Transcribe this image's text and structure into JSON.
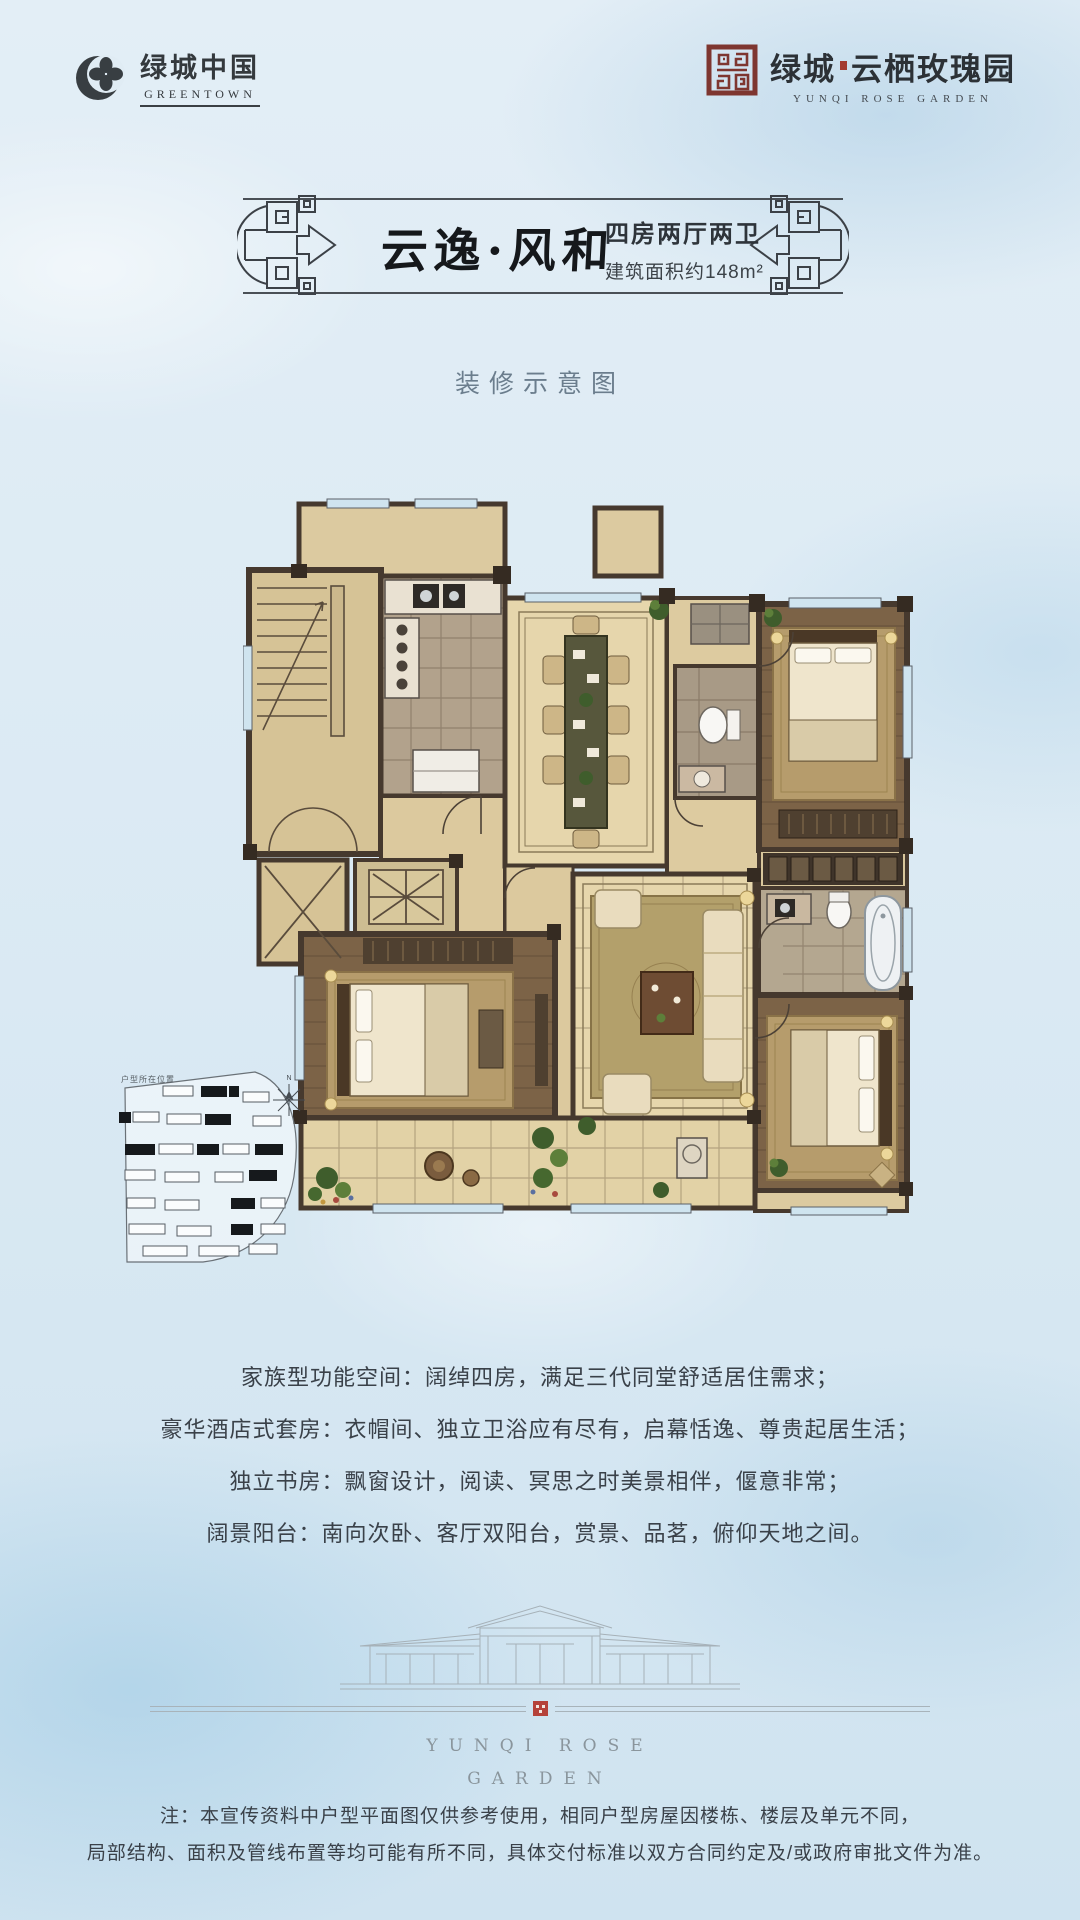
{
  "header": {
    "greentown": {
      "cn": "绿城中国",
      "en": "GREENTOWN"
    },
    "project": {
      "cn_prefix": "绿城",
      "cn_name": "云栖玫瑰园",
      "en": "YUNQI ROSE GARDEN"
    }
  },
  "banner": {
    "title": "云逸·风和",
    "layout": "四房两厅两卫",
    "area": "建筑面积约148m²"
  },
  "caption": "装修示意图",
  "siteplan": {
    "label": "户型所在位置",
    "north": "N"
  },
  "features": [
    "家族型功能空间：阔绰四房，满足三代同堂舒适居住需求；",
    "豪华酒店式套房：衣帽间、独立卫浴应有尽有，启幕恬逸、尊贵起居生活；",
    "独立书房：飘窗设计，阅读、冥思之时美景相伴，偃意非常；",
    "阔景阳台：南向次卧、客厅双阳台，赏景、品茗，俯仰天地之间。"
  ],
  "elevation": {
    "wordmark_line1": "YUNQI ROSE",
    "wordmark_line2": "GARDEN"
  },
  "disclaimer": [
    "注：本宣传资料中户型平面图仅供参考使用，相同户型房屋因楼栋、楼层及单元不同，",
    "局部结构、面积及管线布置等均可能有所不同，具体交付标准以双方合同约定及/或政府审批文件为准。"
  ],
  "colors": {
    "seal_red": "#8e3a33",
    "ink": "#2f353b",
    "caption_blue": "#6b7d8d",
    "wall_brown": "#46392e",
    "floor_beige": "#e6d6ac",
    "wood_brown": "#7c6347"
  }
}
